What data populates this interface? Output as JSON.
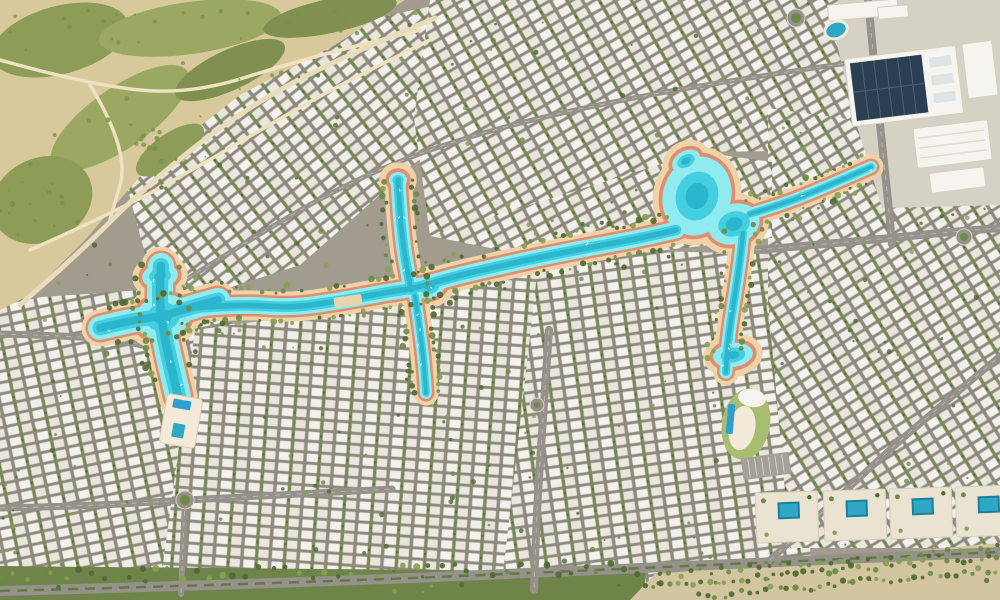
{
  "meta": {
    "description": "Photorealistic aerial render of a desert master-planned villa community with a winding turquoise lagoon",
    "canvas": {
      "width": 1000,
      "height": 600
    },
    "seed": 1234567
  },
  "palette": {
    "fabric_base": "#a29c8f",
    "tile_street": "#8d897e",
    "villa_a": "#f1efe9",
    "villa_b": "#e8e5dd",
    "villa_c": "#f4f2ed",
    "villa_d": "#ebe8e0",
    "villa_edge": "#c6c2b8",
    "hedge": "#6d8a46",
    "tree_dark": "#50682f",
    "tree_mid": "#6d8a46",
    "tree_light": "#86a055",
    "tree_olive": "#7b8f4a",
    "sand": "#d7c99c",
    "sand_light": "#e9dcba",
    "trail": "#eee2c0",
    "scrub": "#8d9c57",
    "scrub_dark": "#7f9050",
    "scrub_light": "#9aa862",
    "beach_sand": "#efd2a8",
    "beach_rim": "#dd8f70",
    "water_light": "#8febef",
    "water_deep": "#44cfe0",
    "water_core": "#2cb6ce",
    "pool_blue": "#2f9fd2",
    "pool_deep": "#1f7f99",
    "pool_teal": "#2fa8c8",
    "road": "#96918a",
    "road_light": "#cfc8b6",
    "road_dark": "#8f8b80",
    "median_green": "#5f7a40",
    "lane_mark": "#d8d4c8",
    "deck": "#f3ead8",
    "deck_edge": "#d9cdb4",
    "bldg_white": "#f6f4ef",
    "bldg_beige": "#eae3d2",
    "bldg_edge": "#d6cfbf",
    "solar": "#2c3e52",
    "solar_line": "#4c6278",
    "strip_green": "#6e8448",
    "avenue_sand": "#d3c5a0",
    "green_roof": "#a9bd72",
    "commercial_ground": "#d6d1c5",
    "bridge": "#e8d5ae"
  },
  "open_land": {
    "polygon": [
      [
        0,
        0
      ],
      [
        405,
        0
      ],
      [
        335,
        45
      ],
      [
        240,
        95
      ],
      [
        150,
        165
      ],
      [
        85,
        240
      ],
      [
        30,
        295
      ],
      [
        0,
        310
      ]
    ],
    "scrub_patches": [
      {
        "cx": 60,
        "cy": 40,
        "rx": 70,
        "ry": 34,
        "rot": -15,
        "c": "scrub"
      },
      {
        "cx": 190,
        "cy": 28,
        "rx": 92,
        "ry": 26,
        "rot": -8,
        "c": "scrub_light"
      },
      {
        "cx": 330,
        "cy": 16,
        "rx": 68,
        "ry": 17,
        "rot": -12,
        "c": "scrub_dark"
      },
      {
        "cx": 120,
        "cy": 118,
        "rx": 82,
        "ry": 30,
        "rot": -35,
        "c": "scrub_light"
      },
      {
        "cx": 42,
        "cy": 200,
        "rx": 52,
        "ry": 42,
        "rot": -25,
        "c": "scrub"
      },
      {
        "cx": 230,
        "cy": 70,
        "rx": 60,
        "ry": 20,
        "rot": -25,
        "c": "scrub_dark"
      },
      {
        "cx": 170,
        "cy": 150,
        "rx": 40,
        "ry": 16,
        "rot": -35,
        "c": "scrub"
      }
    ],
    "trails": [
      [
        [
          0,
          60
        ],
        [
          90,
          85
        ],
        [
          190,
          95
        ],
        [
          300,
          60
        ],
        [
          420,
          30
        ]
      ],
      [
        [
          30,
          250
        ],
        [
          120,
          210
        ],
        [
          210,
          160
        ],
        [
          320,
          95
        ],
        [
          430,
          40
        ]
      ],
      [
        [
          90,
          85
        ],
        [
          130,
          150
        ],
        [
          110,
          220
        ]
      ]
    ],
    "edge_road": [
      [
        435,
        18
      ],
      [
        330,
        62
      ],
      [
        240,
        112
      ],
      [
        150,
        182
      ],
      [
        80,
        252
      ],
      [
        20,
        305
      ]
    ],
    "shrub_count": 80
  },
  "districts": [
    {
      "name": "northwest-villas",
      "polygon": [
        [
          120,
          160
        ],
        [
          330,
          28
        ],
        [
          460,
          0
        ],
        [
          465,
          120
        ],
        [
          300,
          265
        ],
        [
          160,
          310
        ]
      ],
      "angle": -38
    },
    {
      "name": "north-central-villas",
      "polygon": [
        [
          430,
          0
        ],
        [
          880,
          0
        ],
        [
          880,
          150
        ],
        [
          700,
          152
        ],
        [
          560,
          230
        ],
        [
          430,
          236
        ],
        [
          414,
          118
        ]
      ],
      "angle": -30
    },
    {
      "name": "west-villas",
      "polygon": [
        [
          0,
          300
        ],
        [
          170,
          288
        ],
        [
          242,
          328
        ],
        [
          242,
          430
        ],
        [
          205,
          600
        ],
        [
          0,
          600
        ]
      ],
      "angle": -12
    },
    {
      "name": "south-central-villas",
      "polygon": [
        [
          195,
          330
        ],
        [
          430,
          298
        ],
        [
          560,
          252
        ],
        [
          566,
          600
        ],
        [
          158,
          600
        ]
      ],
      "angle": 4
    },
    {
      "name": "east-central-villas",
      "polygon": [
        [
          540,
          248
        ],
        [
          800,
          255
        ],
        [
          812,
          600
        ],
        [
          500,
          600
        ]
      ],
      "angle": -8
    },
    {
      "name": "east-villas",
      "polygon": [
        [
          768,
          108
        ],
        [
          1000,
          140
        ],
        [
          1000,
          548
        ],
        [
          790,
          548
        ],
        [
          768,
          300
        ]
      ],
      "angle": -32
    },
    {
      "name": "mid-lagoon-villas",
      "polygon": [
        [
          430,
          236
        ],
        [
          700,
          152
        ],
        [
          772,
          162
        ],
        [
          772,
          238
        ],
        [
          560,
          262
        ]
      ],
      "angle": -28
    }
  ],
  "commercial_ground": {
    "polygon": [
      [
        838,
        0
      ],
      [
        1000,
        0
      ],
      [
        1000,
        205
      ],
      [
        882,
        208
      ],
      [
        855,
        120
      ],
      [
        836,
        40
      ]
    ]
  },
  "strips": {
    "bottom_green": {
      "polygon": [
        [
          0,
          566
        ],
        [
          645,
          572
        ],
        [
          645,
          600
        ],
        [
          0,
          600
        ]
      ]
    },
    "avenue_sand": {
      "polygon": [
        [
          630,
          600
        ],
        [
          655,
          574
        ],
        [
          1000,
          543
        ],
        [
          1000,
          600
        ]
      ]
    },
    "tree_rows": [
      {
        "line": [
          [
            0,
            576
          ],
          [
            640,
            568
          ]
        ],
        "step": 13,
        "jitter": 6,
        "rmin": 2,
        "rmax": 3.6
      },
      {
        "line": [
          [
            645,
            586
          ],
          [
            1000,
            556
          ]
        ],
        "step": 8,
        "jitter": 4,
        "rmin": 1.8,
        "rmax": 3.2
      },
      {
        "line": [
          [
            700,
            596
          ],
          [
            1000,
            570
          ]
        ],
        "step": 8,
        "jitter": 4,
        "rmin": 1.8,
        "rmax": 3.2
      },
      {
        "line": [
          [
            660,
            575
          ],
          [
            1000,
            548
          ]
        ],
        "step": 10,
        "jitter": 3,
        "rmin": 1.6,
        "rmax": 2.8
      }
    ]
  },
  "roads": [
    {
      "name": "bottom-boulevard",
      "points": [
        [
          0,
          591
        ],
        [
          300,
          583
        ],
        [
          620,
          569
        ],
        [
          1000,
          552
        ]
      ],
      "width": 10,
      "median": true
    },
    {
      "name": "west-access-road",
      "points": [
        [
          0,
          334
        ],
        [
          80,
          336
        ],
        [
          140,
          343
        ],
        [
          178,
          357
        ]
      ],
      "width": 7,
      "median": false
    },
    {
      "name": "center-vertical-road",
      "points": [
        [
          549,
          330
        ],
        [
          543,
          420
        ],
        [
          537,
          505
        ],
        [
          534,
          590
        ]
      ],
      "width": 8,
      "median": false
    },
    {
      "name": "west-cross-road",
      "points": [
        [
          0,
          508
        ],
        [
          90,
          506
        ],
        [
          185,
          500
        ],
        [
          300,
          494
        ],
        [
          392,
          489
        ]
      ],
      "width": 7,
      "median": false
    },
    {
      "name": "west-south-road",
      "points": [
        [
          185,
          500
        ],
        [
          183,
          545
        ],
        [
          181,
          594
        ]
      ],
      "width": 6,
      "median": false
    },
    {
      "name": "northeast-vertical-road",
      "points": [
        [
          868,
          0
        ],
        [
          874,
          60
        ],
        [
          880,
          125
        ],
        [
          888,
          200
        ],
        [
          892,
          244
        ]
      ],
      "width": 8,
      "median": false
    },
    {
      "name": "northeast-horizontal-road",
      "points": [
        [
          756,
          250
        ],
        [
          850,
          242
        ],
        [
          950,
          232
        ],
        [
          1000,
          228
        ]
      ],
      "width": 8,
      "median": false
    },
    {
      "name": "east-diagonal-road",
      "points": [
        [
          770,
          560
        ],
        [
          840,
          496
        ],
        [
          900,
          440
        ],
        [
          960,
          390
        ],
        [
          1000,
          356
        ]
      ],
      "width": 7,
      "median": false
    },
    {
      "name": "north-arc-collector",
      "points": [
        [
          150,
          302
        ],
        [
          230,
          252
        ],
        [
          330,
          192
        ],
        [
          420,
          152
        ],
        [
          520,
          122
        ],
        [
          640,
          96
        ],
        [
          760,
          76
        ],
        [
          868,
          60
        ]
      ],
      "width": 5,
      "median": false
    }
  ],
  "lagoon": {
    "channels": [
      {
        "name": "main-channel",
        "points": [
          [
            196,
            308
          ],
          [
            240,
            304
          ],
          [
            290,
            308
          ],
          [
            340,
            301
          ],
          [
            388,
            292
          ],
          [
            416,
            288
          ],
          [
            452,
            277
          ],
          [
            500,
            266
          ],
          [
            546,
            256
          ],
          [
            592,
            247
          ],
          [
            636,
            239
          ],
          [
            676,
            230
          ]
        ],
        "width": 17
      },
      {
        "name": "west-pool-horizontal-arm",
        "points": [
          [
            100,
            328
          ],
          [
            128,
            321
          ],
          [
            163,
            316
          ],
          [
            196,
            306
          ],
          [
            218,
            300
          ]
        ],
        "width": 24
      },
      {
        "name": "west-pool-vertical-arm",
        "points": [
          [
            161,
            266
          ],
          [
            159,
            298
          ],
          [
            163,
            330
          ],
          [
            170,
            362
          ],
          [
            178,
            396
          ]
        ],
        "width": 26
      },
      {
        "name": "north-branch",
        "points": [
          [
            398,
            181
          ],
          [
            400,
            215
          ],
          [
            404,
            252
          ],
          [
            411,
            290
          ]
        ],
        "width": 15
      },
      {
        "name": "south-stub-branch",
        "points": [
          [
            415,
            296
          ],
          [
            420,
            330
          ],
          [
            424,
            364
          ],
          [
            426,
            393
          ]
        ],
        "width": 12
      },
      {
        "name": "northeast-channel",
        "points": [
          [
            750,
            214
          ],
          [
            786,
            203
          ],
          [
            820,
            189
          ],
          [
            848,
            177
          ],
          [
            871,
            167
          ]
        ],
        "width": 12
      },
      {
        "name": "southeast-branch",
        "points": [
          [
            743,
            233
          ],
          [
            740,
            262
          ],
          [
            735,
            294
          ],
          [
            730,
            326
          ],
          [
            727,
            352
          ],
          [
            726,
            372
          ]
        ],
        "width": 13
      }
    ],
    "pools": [
      {
        "name": "west-pool-center",
        "cx": 163,
        "cy": 317,
        "rx": 28,
        "ry": 22,
        "rot": -15
      },
      {
        "name": "west-pool-north-bulge",
        "cx": 160,
        "cy": 276,
        "rx": 18,
        "ry": 12,
        "rot": -8
      },
      {
        "name": "east-pool-main",
        "cx": 697,
        "cy": 196,
        "rx": 34,
        "ry": 40,
        "rot": 18
      },
      {
        "name": "east-pool-sub",
        "cx": 734,
        "cy": 224,
        "rx": 26,
        "ry": 20,
        "rot": -18
      },
      {
        "name": "east-pool-lobe",
        "cx": 686,
        "cy": 161,
        "rx": 15,
        "ry": 10,
        "rot": -30
      },
      {
        "name": "southeast-tip-pool",
        "cx": 733,
        "cy": 355,
        "rx": 20,
        "ry": 12,
        "rot": -8
      },
      {
        "name": "junction-widening",
        "cx": 430,
        "cy": 287,
        "rx": 16,
        "ry": 11,
        "rot": -20
      },
      {
        "name": "north-branch-tip",
        "cx": 398,
        "cy": 180,
        "rx": 9,
        "ry": 8,
        "rot": 0
      }
    ],
    "bridge": {
      "x": 348,
      "y": 301,
      "w": 10,
      "h": 28,
      "rot": 82
    },
    "boat_count": 22
  },
  "vegetation": {
    "scatter_count": 300,
    "fringe_step": 7
  },
  "landmarks": {
    "solar_building": {
      "x": 848,
      "y": 52,
      "w": 112,
      "h": 68,
      "rot": -7,
      "panel_w": 72,
      "skylights": 3,
      "grid_lines": 6
    },
    "commercial_buildings": [
      {
        "x": 828,
        "y": 2,
        "w": 70,
        "h": 16,
        "rot": -5,
        "ribbed": false
      },
      {
        "x": 878,
        "y": 6,
        "w": 30,
        "h": 12,
        "rot": -5,
        "ribbed": false
      },
      {
        "x": 965,
        "y": 42,
        "w": 30,
        "h": 55,
        "rot": -7,
        "ribbed": false
      },
      {
        "x": 915,
        "y": 124,
        "w": 75,
        "h": 40,
        "rot": -7,
        "ribbed": true
      },
      {
        "x": 930,
        "y": 170,
        "w": 55,
        "h": 20,
        "rot": -7,
        "ribbed": false
      }
    ],
    "topright_pool": {
      "cx": 836,
      "cy": 30,
      "rx": 10,
      "ry": 7,
      "rot": -20
    },
    "west_beach_club": {
      "x": 163,
      "y": 396,
      "w": 36,
      "h": 50,
      "rot": 10,
      "pool1": [
        7,
        4,
        18,
        9
      ],
      "pool2": [
        11,
        28,
        12,
        14
      ]
    },
    "east_beach_club": {
      "cx": 746,
      "cy": 424,
      "rx": 24,
      "ry": 36,
      "rot": 10,
      "lap_pool": [
        727,
        404,
        7,
        30,
        5
      ]
    },
    "pool_villas": [
      {
        "x": 756,
        "y": 492,
        "w": 62,
        "h": 50,
        "rot": -2
      },
      {
        "x": 824,
        "y": 490,
        "w": 62,
        "h": 50,
        "rot": -2
      },
      {
        "x": 890,
        "y": 488,
        "w": 62,
        "h": 50,
        "rot": -2
      },
      {
        "x": 956,
        "y": 486,
        "w": 62,
        "h": 50,
        "rot": -2
      }
    ],
    "parking_lot": {
      "x": 742,
      "y": 455,
      "w": 48,
      "h": 22,
      "rot": -8,
      "slots": 7
    },
    "roundabouts": [
      {
        "cx": 796,
        "cy": 18,
        "r": 9
      },
      {
        "cx": 964,
        "cy": 237,
        "r": 8
      },
      {
        "cx": 185,
        "cy": 500,
        "r": 9
      },
      {
        "cx": 537,
        "cy": 405,
        "r": 7
      }
    ]
  }
}
